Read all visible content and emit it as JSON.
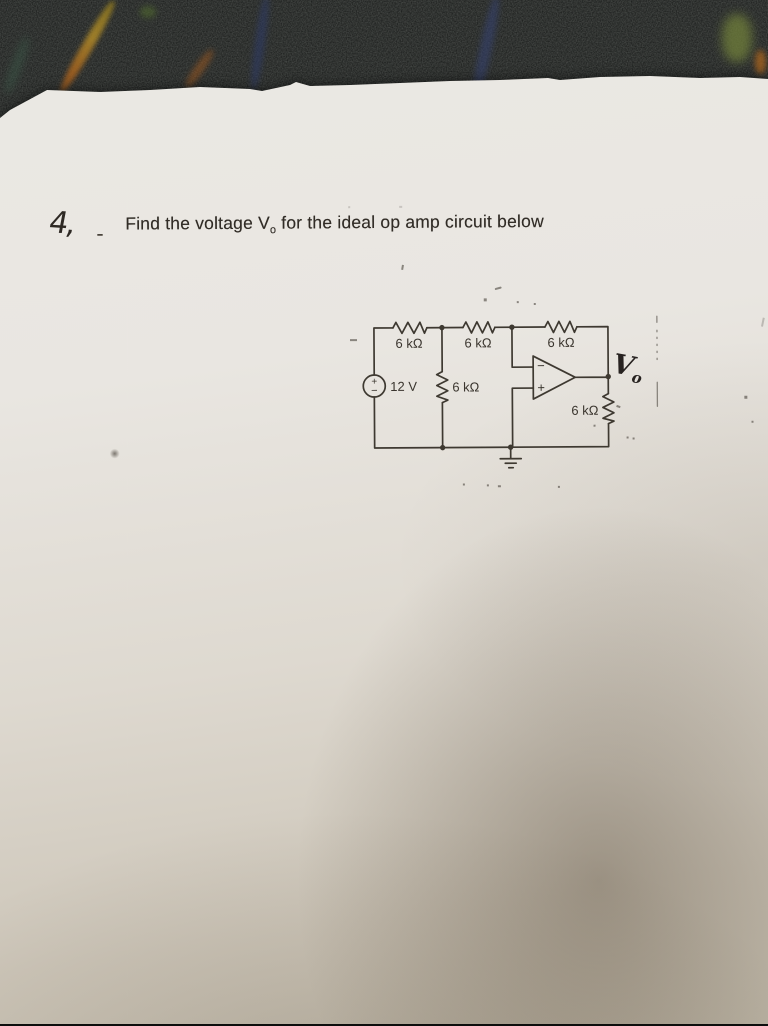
{
  "problem": {
    "number": "4,",
    "dash": "-",
    "title_pre": "Find the voltage V",
    "title_sub": "o",
    "title_post": " for the ideal op amp circuit below"
  },
  "circuit": {
    "source_label": "12 V",
    "source_plus": "+",
    "source_minus": "−",
    "r1_label": "6 kΩ",
    "r2_label": "6 kΩ",
    "r3_label": "6 kΩ",
    "r4_label": "6 kΩ",
    "r5_label": "6 kΩ",
    "opamp_minus": "−",
    "opamp_plus": "+",
    "vo_pre": "V",
    "vo_sub": "o"
  },
  "colors": {
    "ink": "#3e3931",
    "paper": "#e9e6e1",
    "carpet": "#131514"
  }
}
